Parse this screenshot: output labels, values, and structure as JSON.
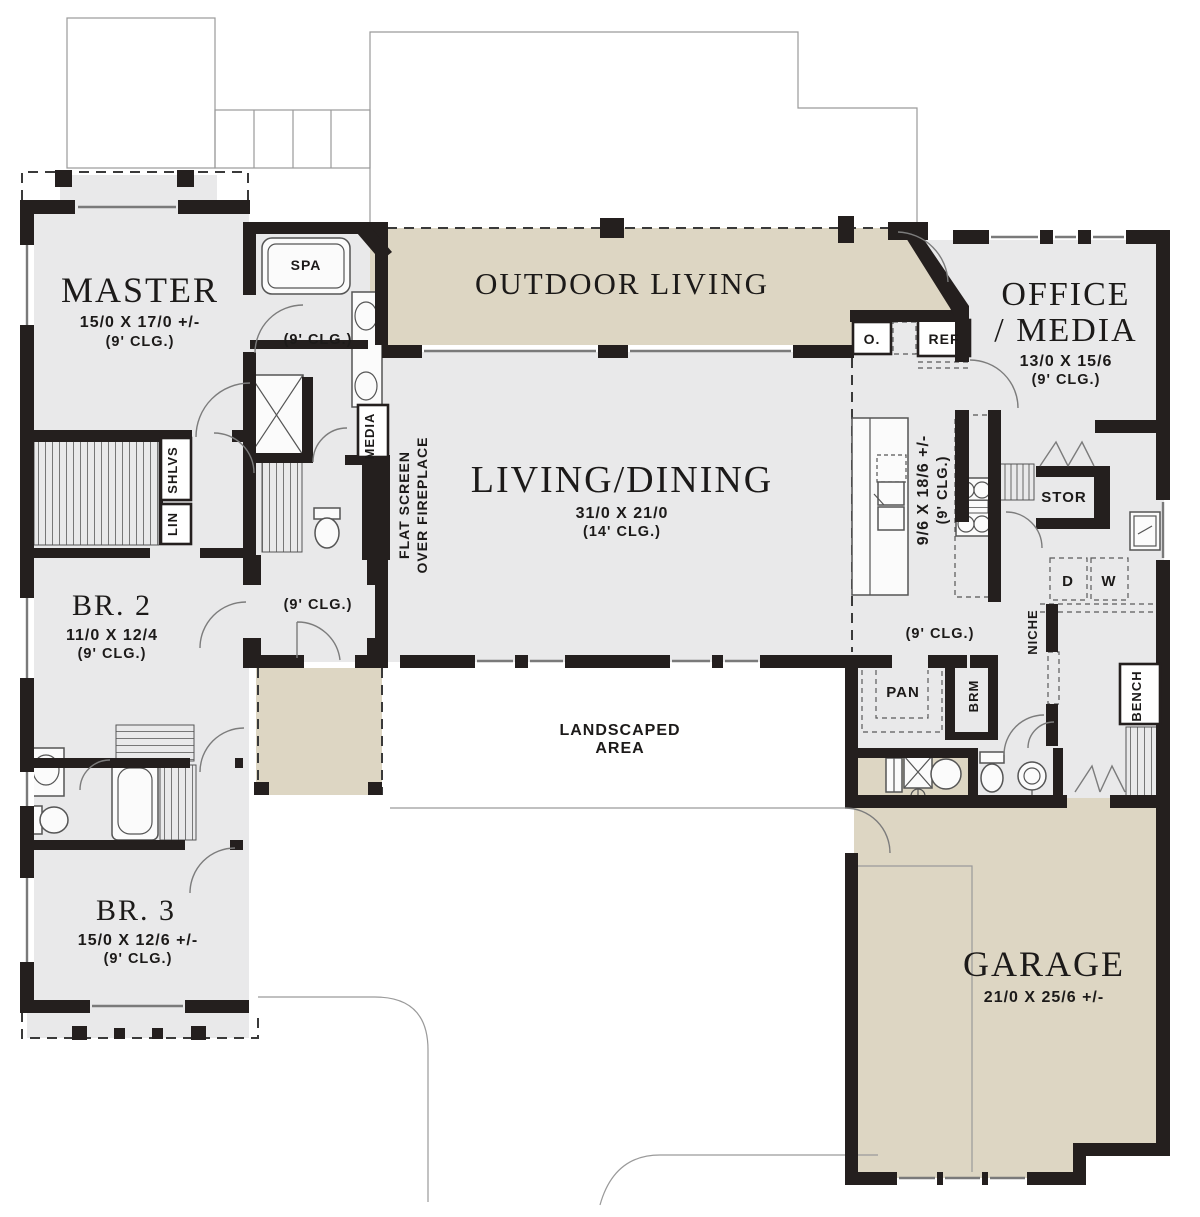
{
  "plan": {
    "rooms": {
      "master": {
        "name": "MASTER",
        "dims": "15/0 X 17/0 +/-",
        "ceiling": "(9' CLG.)"
      },
      "master_hall": {
        "ceiling": "(9' CLG.)"
      },
      "outdoor_living": {
        "name": "OUTDOOR LIVING"
      },
      "office_media": {
        "name_line1": "OFFICE",
        "name_line2": "/ MEDIA",
        "dims": "13/0 X 15/6",
        "ceiling": "(9' CLG.)"
      },
      "living_dining": {
        "name": "LIVING/DINING",
        "dims": "31/0 X 21/0",
        "ceiling": "(14' CLG.)"
      },
      "kitchen": {
        "dims": "9/6 X 18/6 +/-",
        "ceiling": "(9' CLG.)"
      },
      "entry": {
        "ceiling": "(9' CLG.)"
      },
      "mud_hall": {
        "ceiling": "(9' CLG.)"
      },
      "br2": {
        "name": "BR. 2",
        "dims": "11/0 X 12/4",
        "ceiling": "(9' CLG.)"
      },
      "br3": {
        "name": "BR. 3",
        "dims": "15/0 X 12/6 +/-",
        "ceiling": "(9' CLG.)"
      },
      "garage": {
        "name": "GARAGE",
        "dims": "21/0 X 25/6 +/-"
      },
      "landscaped_area": {
        "name_line1": "LANDSCAPED",
        "name_line2": "AREA"
      }
    },
    "fixtures": {
      "spa": "SPA",
      "oven": "O.",
      "fridge": "REF",
      "media": "MEDIA",
      "fireplace_line1": "FLAT SCREEN",
      "fireplace_line2": "OVER FIREPLACE",
      "shelves": "SHLVS",
      "linen": "LIN",
      "storage": "STOR",
      "dryer": "D",
      "washer": "W",
      "pantry": "PAN",
      "broom": "BRM",
      "niche": "NICHE",
      "bench": "BENCH"
    },
    "colors": {
      "wall": "#241f1e",
      "interior_floor": "#e9e9ea",
      "outdoor_floor": "#ddd6c3",
      "thin_line": "#9a9a9a",
      "text": "#1c1a19",
      "background": "#ffffff"
    }
  }
}
